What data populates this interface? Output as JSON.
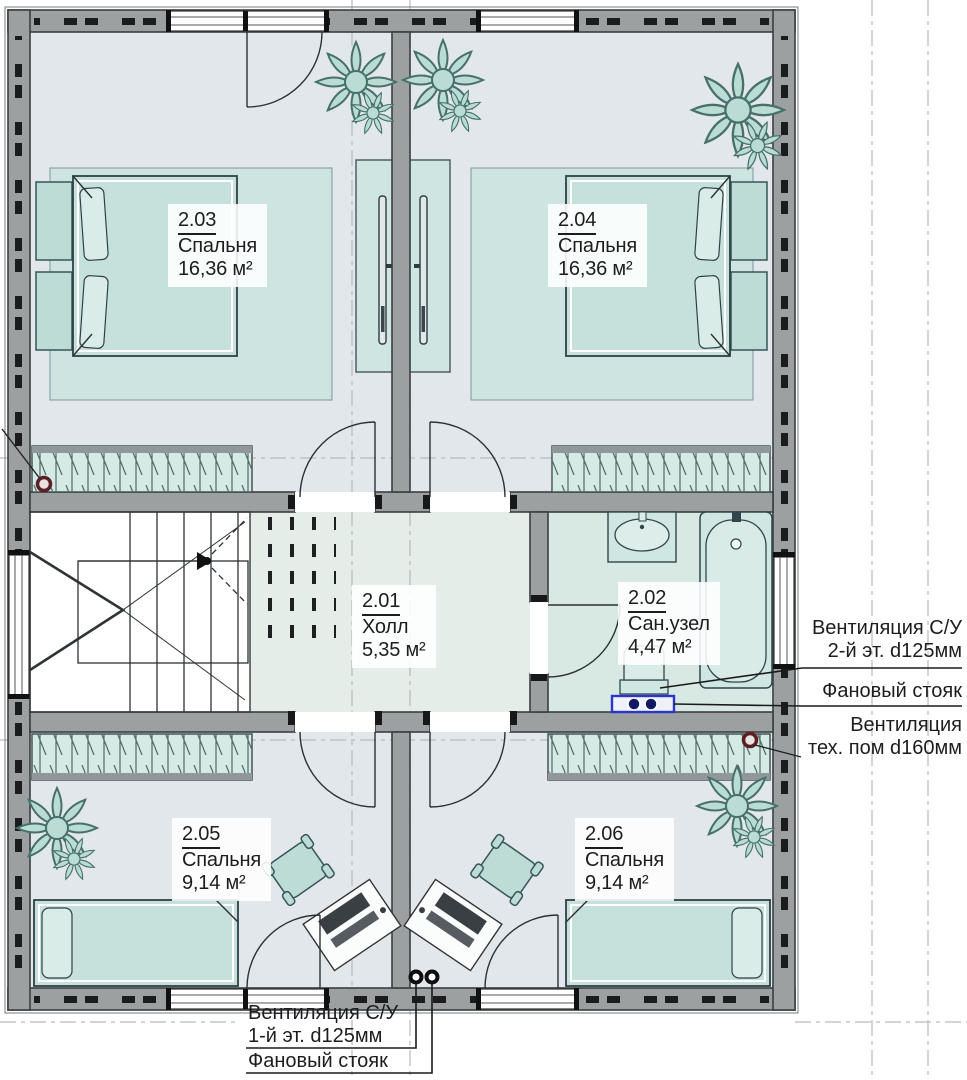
{
  "rooms": [
    {
      "number": "2.03",
      "name": "Спальня",
      "area": "16,36 м²"
    },
    {
      "number": "2.04",
      "name": "Спальня",
      "area": "16,36 м²"
    },
    {
      "number": "2.01",
      "name": "Холл",
      "area": "5,35 м²"
    },
    {
      "number": "2.02",
      "name": "Сан.узел",
      "area": "4,47 м²"
    },
    {
      "number": "2.05",
      "name": "Спальня",
      "area": "9,14 м²"
    },
    {
      "number": "2.06",
      "name": "Спальня",
      "area": "9,14 м²"
    }
  ],
  "annotations": {
    "right": [
      {
        "line1": "Вентиляция С/У",
        "line2": "2-й эт. d125мм"
      },
      {
        "line1": "Фановый стояк"
      },
      {
        "line1": "Вентиляция",
        "line2": "тех. пом d160мм"
      }
    ],
    "bottom": [
      {
        "line1": "Вентиляция С/У",
        "line2": "1-й эт. d125мм"
      },
      {
        "line1": "Фановый стояк"
      }
    ]
  },
  "colors": {
    "wall_gray": "#9ca0a1",
    "floor_blue_gray": "#e2e7eb",
    "floor_hall_green": "#e5ede8",
    "floor_bath_teal": "#d8e9e4",
    "furniture_teal": "#bddcd6",
    "riser_blue": "#2c35c8",
    "vent_red": "#5b2026"
  }
}
